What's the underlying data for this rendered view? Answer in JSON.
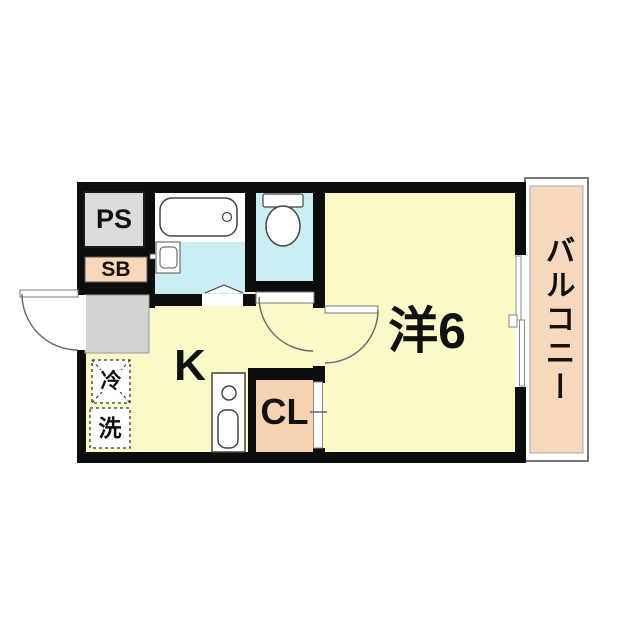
{
  "floorplan": {
    "type": "apartment-floor-plan",
    "labels": {
      "pipe_space": "PS",
      "shoe_box": "SB",
      "kitchen": "K",
      "closet": "CL",
      "western_room": "洋6",
      "balcony": "バルコニー",
      "refrigerator": "冷",
      "washing_machine": "洗"
    },
    "colors": {
      "floor_yellow": "#FBF9C7",
      "wet_area_cyan": "#C8EEF4",
      "balcony_peach": "#F6D9BC",
      "storage_peach": "#F6D2B0",
      "shoebox_peach": "#F8D8B8",
      "utility_gray": "#DCDCDC",
      "entrance_gray": "#D3D3D3",
      "wall_black": "#0D0D0D"
    }
  }
}
